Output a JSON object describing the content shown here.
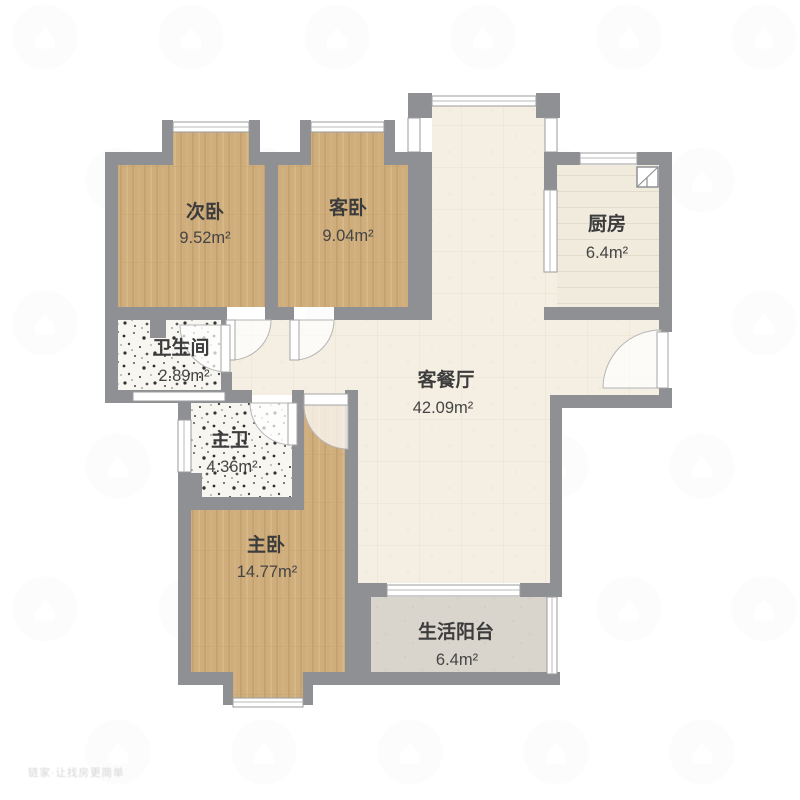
{
  "floorplan": {
    "rooms": [
      {
        "key": "secondary-bedroom",
        "name": "次卧",
        "area": "9.52m²"
      },
      {
        "key": "guest-bedroom",
        "name": "客卧",
        "area": "9.04m²"
      },
      {
        "key": "kitchen",
        "name": "厨房",
        "area": "6.4m²"
      },
      {
        "key": "bathroom",
        "name": "卫生间",
        "area": "2.89m²"
      },
      {
        "key": "living-dining",
        "name": "客餐厅",
        "area": "42.09m²"
      },
      {
        "key": "master-bath",
        "name": "主卫",
        "area": "4.36m²"
      },
      {
        "key": "master-bedroom",
        "name": "主卧",
        "area": "14.77m²"
      },
      {
        "key": "living-balcony",
        "name": "生活阳台",
        "area": "6.4m²"
      }
    ],
    "watermark_text": "链家·让找房更简单",
    "colors": {
      "wall": "#8f9094",
      "wood": "#cfad7c",
      "cream": "#f4efe2",
      "kitchen_floor": "#f1ebde",
      "speckle_base": "#f8f6f1",
      "balcony_floor": "#d9d5cc",
      "label": "#3c3c3c",
      "window": "#ffffff"
    }
  }
}
